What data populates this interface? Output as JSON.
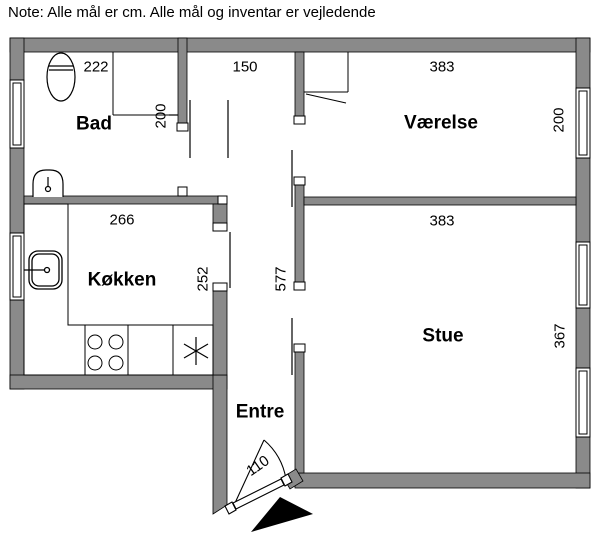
{
  "note": "Note: Alle mål er cm. Alle mål og inventar er vejledende",
  "colors": {
    "wall_fill": "#8a8a8a",
    "line": "#000000",
    "background": "#ffffff"
  },
  "rooms": {
    "bad": {
      "label": "Bad",
      "width_cm": "222",
      "depth_cm": "200"
    },
    "vaerelse": {
      "label": "Værelse",
      "width_cm": "383",
      "depth_cm": "200"
    },
    "koekken": {
      "label": "Køkken",
      "width_cm": "266",
      "depth_cm": "252"
    },
    "stue": {
      "label": "Stue",
      "width_cm": "383",
      "depth_cm": "367"
    },
    "entre": {
      "label": "Entre",
      "hall_top_width_cm": "150",
      "hall_length_cm": "577",
      "entrance_door_cm": "110"
    }
  }
}
